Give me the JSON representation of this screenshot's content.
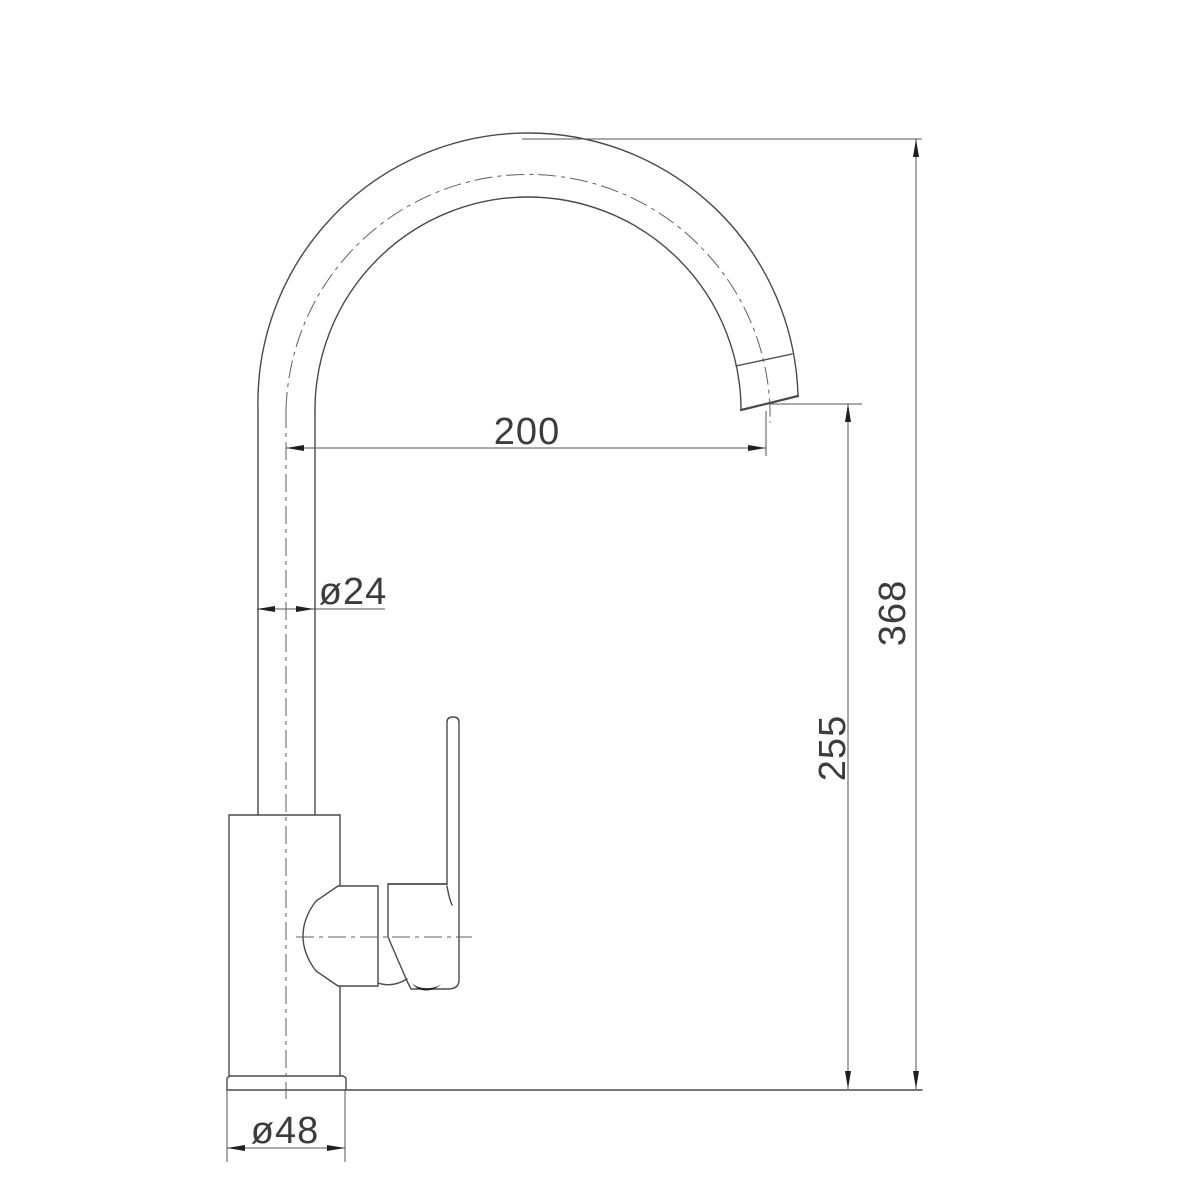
{
  "drawing": {
    "type": "technical-dimension-drawing",
    "subject": "kitchen mixer tap with gooseneck spout, side view",
    "dimensions": {
      "spout_reach": "200",
      "spout_tube_diameter": "ø24",
      "overall_height": "368",
      "spout_outlet_height": "255",
      "base_diameter": "ø48"
    },
    "colors": {
      "background": "#ffffff",
      "outline": "#4a4a4a",
      "dimension_line": "#565656",
      "centerline": "#5f5f5f",
      "arrow": "#1f1f1f",
      "text": "#3c3c3c"
    }
  }
}
